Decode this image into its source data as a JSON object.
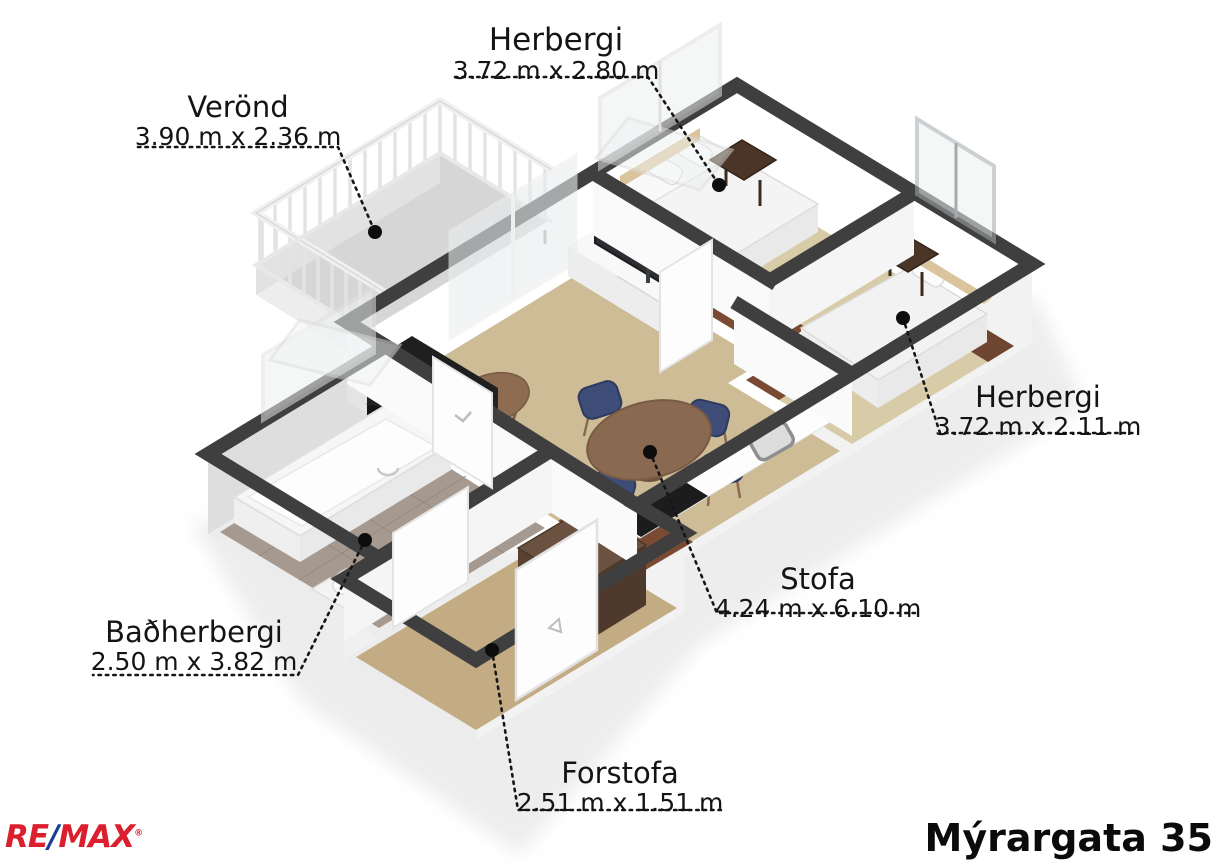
{
  "address": "Mýrargata 35",
  "brand": {
    "re": "RE",
    "slash": "/",
    "max": "MAX",
    "registered": "®"
  },
  "rooms": [
    {
      "id": "herbergi-top",
      "name": "Herbergi",
      "dims": "3.72 m x 2.80 m"
    },
    {
      "id": "verond",
      "name": "Verönd",
      "dims": "3.90 m x 2.36 m"
    },
    {
      "id": "herbergi-right",
      "name": "Herbergi",
      "dims": "3.72 m x 2.11 m"
    },
    {
      "id": "stofa",
      "name": "Stofa",
      "dims": "4.24 m x 6.10 m"
    },
    {
      "id": "badherbergi",
      "name": "Baðherbergi",
      "dims": "2.50 m x 3.82 m"
    },
    {
      "id": "forstofa",
      "name": "Forstofa",
      "dims": "2.51 m x 1.51 m"
    }
  ],
  "colors": {
    "wall_top": "#3f3f3f",
    "wall_face": "#f2f2f2",
    "floor_living": "#cdbc96",
    "floor_bedroom": "#d8cba7",
    "floor_walnut": "#7a4a33",
    "floor_bath_tile": "#a69a90",
    "floor_veranda": "#d6d6d6",
    "chair_blue": "#3e4c78",
    "table_brown": "#8a6951",
    "remax_red": "#dc1f2e",
    "remax_blue": "#1c3e92"
  }
}
